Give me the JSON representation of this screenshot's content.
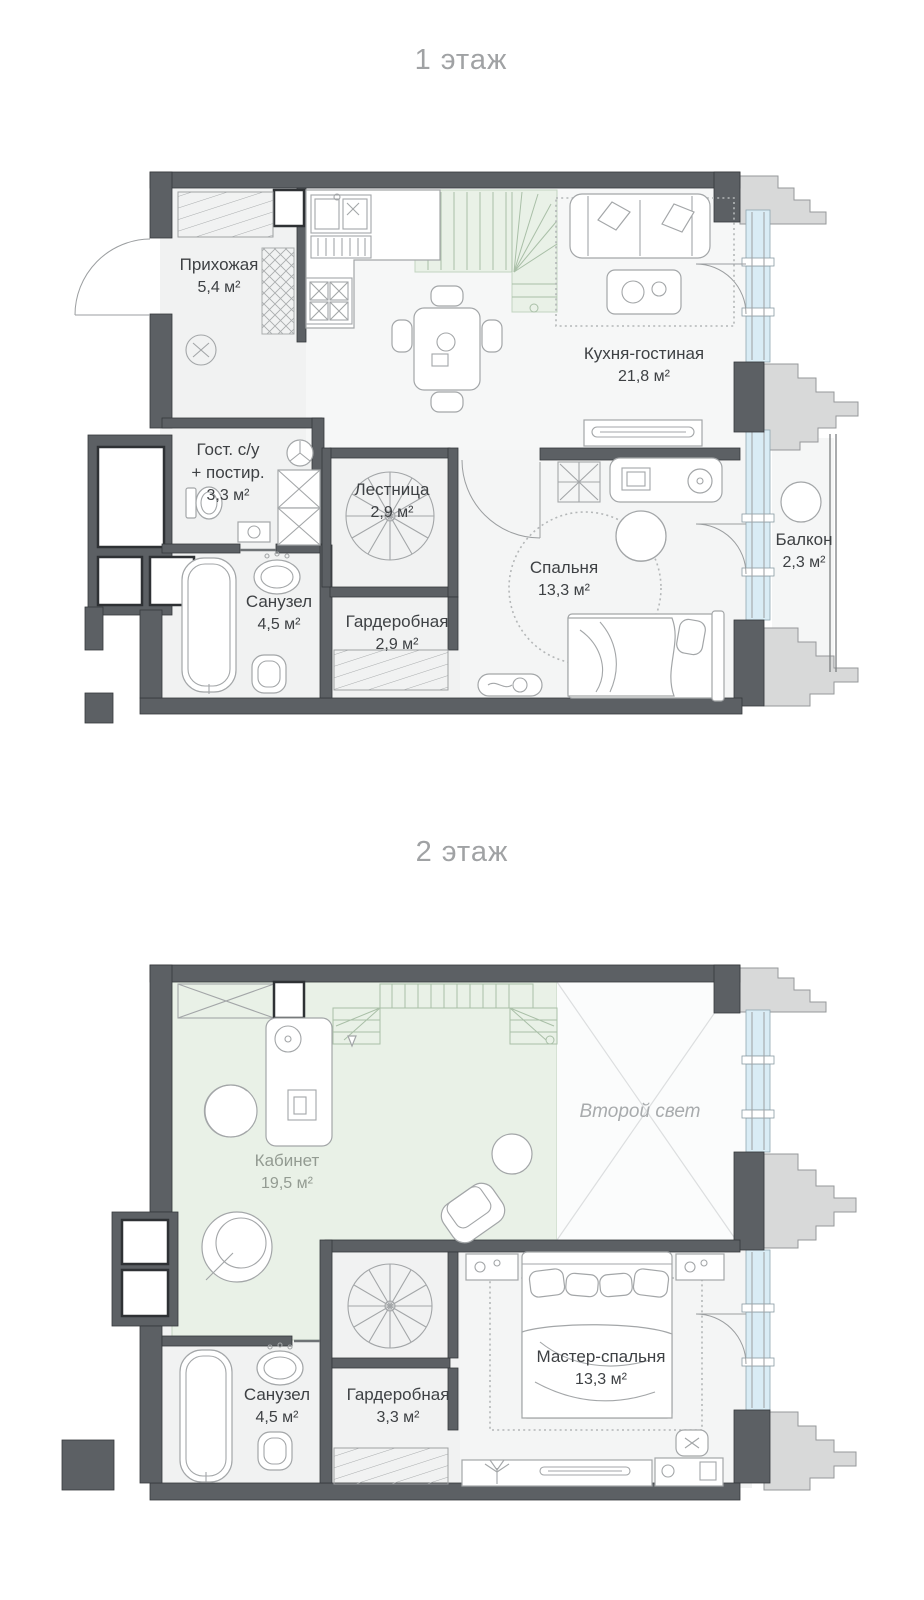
{
  "document": {
    "type": "apartment floor plan",
    "units": "м²"
  },
  "colors": {
    "wall": "#5c6064",
    "window_glass": "#d9ecf5",
    "green_floor": "#e9f1e7",
    "room_floor": "#f2f3f3",
    "facade": "#d8d9d9",
    "label_text": "#3e4144",
    "title_text": "#a0a2a4"
  },
  "floors": [
    {
      "title": "1 этаж",
      "rooms": [
        {
          "id": "hallway",
          "name": "Прихожая",
          "area": "5,4 м²"
        },
        {
          "id": "kitchen-living",
          "name": "Кухня-гостиная",
          "area": "21,8 м²"
        },
        {
          "id": "guest-wc",
          "name": "Гост. с/у",
          "name2": "+ постир.",
          "area": "3,3 м²"
        },
        {
          "id": "stairs",
          "name": "Лестница",
          "area": "2,9 м²"
        },
        {
          "id": "bathroom",
          "name": "Санузел",
          "area": "4,5 м²"
        },
        {
          "id": "wardrobe",
          "name": "Гардеробная",
          "area": "2,9 м²"
        },
        {
          "id": "bedroom",
          "name": "Спальня",
          "area": "13,3 м²"
        },
        {
          "id": "balcony",
          "name": "Балкон",
          "area": "2,3 м²"
        }
      ]
    },
    {
      "title": "2 этаж",
      "rooms": [
        {
          "id": "office",
          "name": "Кабинет",
          "area": "19,5 м²"
        },
        {
          "id": "void",
          "name": "Второй свет",
          "area": ""
        },
        {
          "id": "master-bedroom",
          "name": "Мастер-спальня",
          "area": "13,3 м²"
        },
        {
          "id": "bathroom2",
          "name": "Санузел",
          "area": "4,5 м²"
        },
        {
          "id": "wardrobe2",
          "name": "Гардеробная",
          "area": "3,3 м²"
        }
      ]
    }
  ]
}
